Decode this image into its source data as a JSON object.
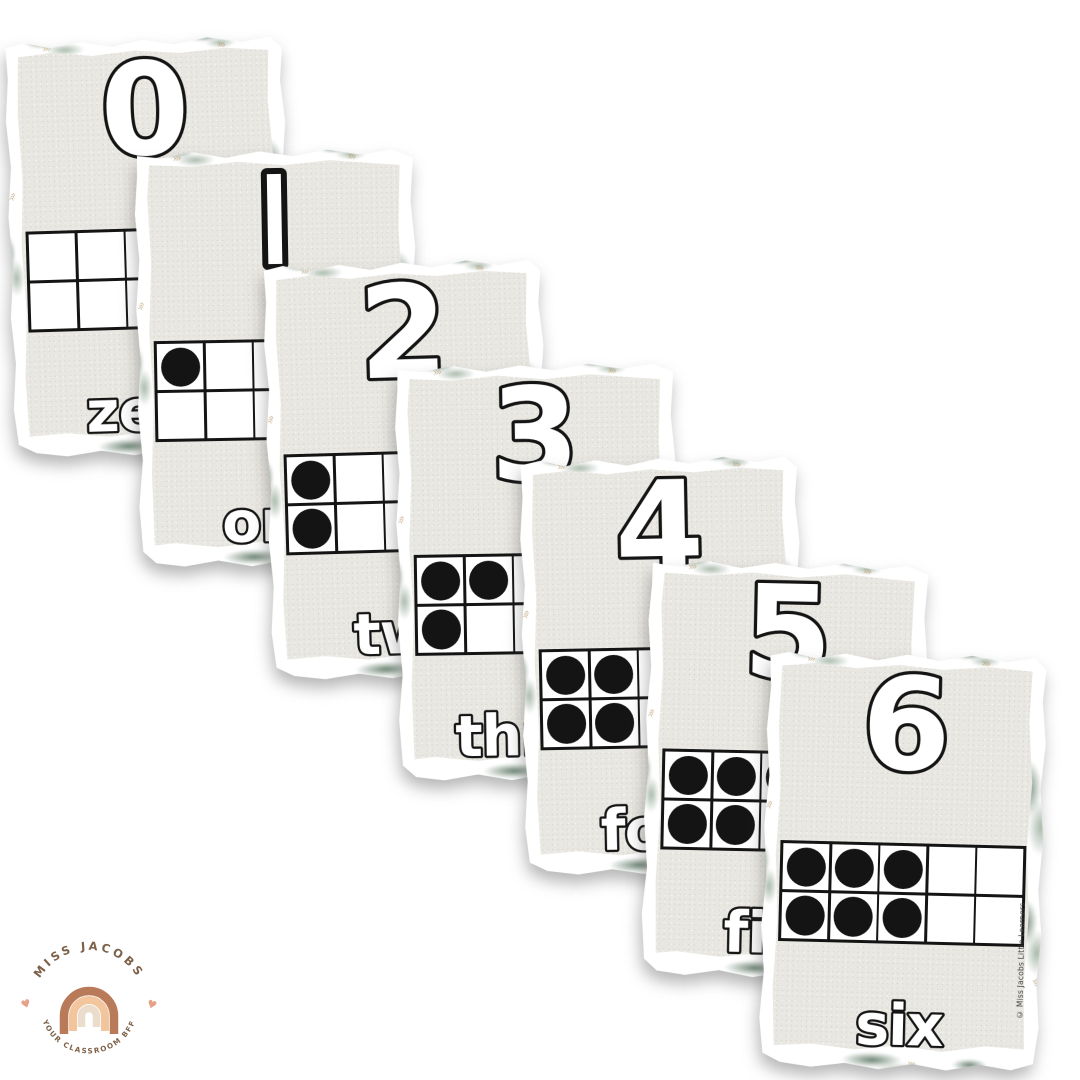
{
  "page": {
    "background": "#ffffff",
    "description": "Overlapping fan of seven number flashcards"
  },
  "cards": [
    {
      "numeral": "0",
      "word": "zero",
      "dot_count": 0
    },
    {
      "numeral": "1",
      "word": "one",
      "dot_count": 1
    },
    {
      "numeral": "2",
      "word": "two",
      "dot_count": 2
    },
    {
      "numeral": "3",
      "word": "three",
      "dot_count": 3
    },
    {
      "numeral": "4",
      "word": "four",
      "dot_count": 4
    },
    {
      "numeral": "5",
      "word": "five",
      "dot_count": 5
    },
    {
      "numeral": "6",
      "word": "six",
      "dot_count": 6
    }
  ],
  "ten_frame": {
    "rows": 2,
    "cols": 5,
    "fill_order": "column-pairs"
  },
  "copyright_text": "© Miss Jacobs Little Learners",
  "logo": {
    "top_text": "MISS JACOBS",
    "bottom_text": "YOUR CLASSROOM BFF",
    "heart": "♥",
    "colors": {
      "text": "#7d6048",
      "heart": "#e8a189",
      "arch_outer": "#b97a59",
      "arch_middle": "#f2c59d",
      "arch_inner": "#ebdccb"
    }
  },
  "card_style": {
    "panel_color": "#e9e7e1",
    "border_color": "#ffffff",
    "ink_color": "#141414",
    "leaf_color": "#77917c",
    "gold_color": "#b28e58",
    "squiggle": "›››"
  }
}
